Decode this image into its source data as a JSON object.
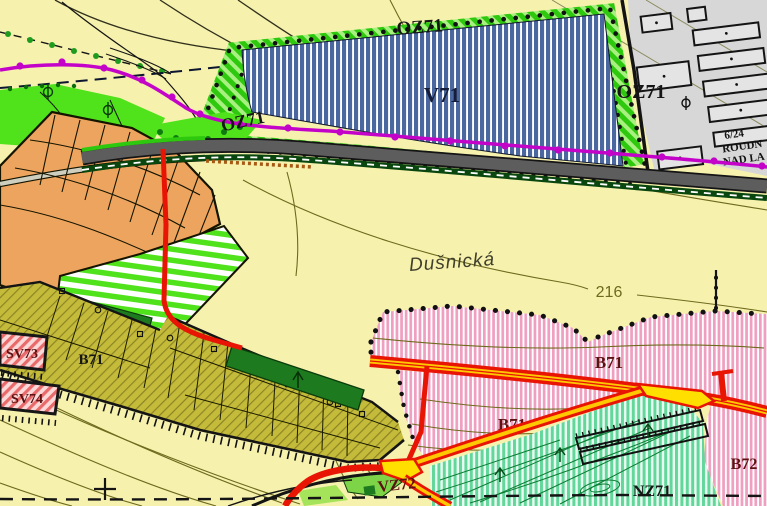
{
  "map": {
    "title": "Zoning plan map detail (územní plán)",
    "labels": {
      "oz71_top": "OZ71",
      "oz71_left": "OZ71",
      "oz71_right": "OZ71",
      "v71": "V71",
      "street": "Dušnická",
      "contour_216": "216",
      "b71_olive": "B71",
      "b71_upper": "B71",
      "b71_lower": "B71",
      "b72": "B72",
      "sv73": "SV73",
      "sv74": "SV74",
      "vz72": "VZ72",
      "nz71": "NZ71",
      "cadastre_line1": "6/24",
      "cadastre_line2": "ROUDN",
      "cadastre_line3": "NAD LA"
    },
    "zones": [
      {
        "code": "V71",
        "style": "blue-vertical-stripes"
      },
      {
        "code": "OZ71",
        "style": "green-diagonal-hatch-band"
      },
      {
        "code": "B71",
        "style": "pink-vertical-stripes-and-olive-parcels"
      },
      {
        "code": "B72",
        "style": "pink-vertical-stripes"
      },
      {
        "code": "SV73",
        "style": "red-diagonal-hatch-parcel"
      },
      {
        "code": "SV74",
        "style": "red-diagonal-hatch-parcel"
      },
      {
        "code": "VZ72",
        "style": "road-junction"
      },
      {
        "code": "NZ71",
        "style": "teal-vertical-stripes"
      }
    ]
  },
  "colors": {
    "background": "#f6f1ad",
    "v71_blue": "#4a67a0",
    "oz_green": "#2ec80e",
    "oz_green_light": "#a8f080",
    "pink": "#ef9fc0",
    "olive": "#c4bb3b",
    "teal_green": "#63d79b",
    "bright_green": "#50e21b",
    "dark_green": "#1d7a1f",
    "orange": "#eda45e",
    "gray_area": "#d7d7d7",
    "road_gray": "#5d5d5d",
    "red_road": "#e81505",
    "road_yellow": "#ffc800",
    "magenta": "#c403c9",
    "contour_olive": "#6e6a1e",
    "label_maroon": "#5c1212",
    "label_black": "#161616"
  }
}
